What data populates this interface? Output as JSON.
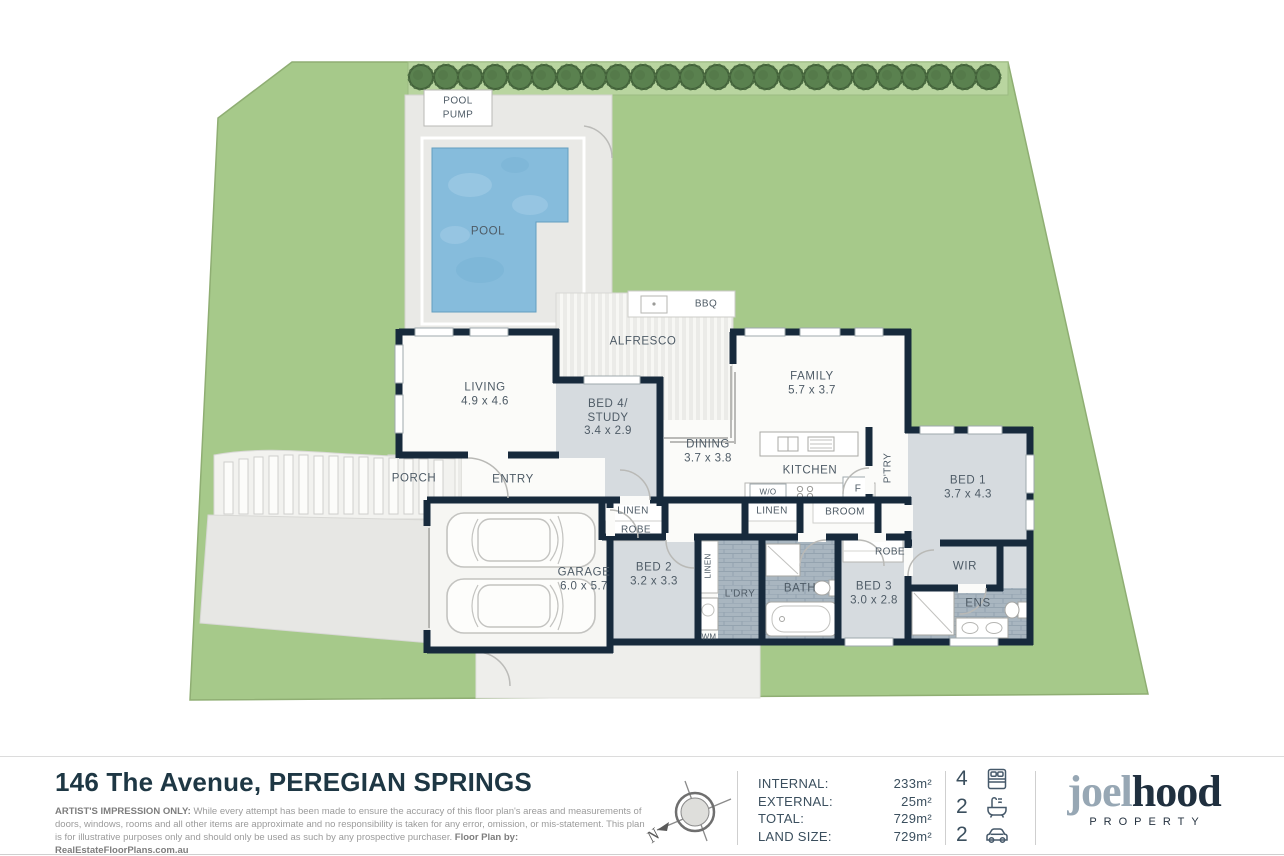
{
  "plan": {
    "pool_pump": {
      "line1": "POOL",
      "line2": "PUMP"
    },
    "pool": "POOL",
    "bbq": "BBQ",
    "alfresco": "ALFRESCO",
    "living": {
      "name": "LIVING",
      "dims": "4.9 x 4.6"
    },
    "bed4": {
      "line1": "BED 4/",
      "line2": "STUDY",
      "dims": "3.4 x 2.9"
    },
    "family": {
      "name": "FAMILY",
      "dims": "5.7 x 3.7"
    },
    "dining": {
      "name": "DINING",
      "dims": "3.7 x 3.8"
    },
    "kitchen": "KITCHEN",
    "wall_oven": "W/O",
    "fridge": "F",
    "pantry": "P'TRY",
    "bed1": {
      "name": "BED 1",
      "dims": "3.7 x 4.3"
    },
    "porch": "PORCH",
    "entry": "ENTRY",
    "linen_entry": "LINEN",
    "robe_entry": "ROBE",
    "linen_hall": "LINEN",
    "broom": "BROOM",
    "garage": {
      "name": "GARAGE",
      "dims": "6.0 x 5.7"
    },
    "bed2": {
      "name": "BED 2",
      "dims": "3.2 x 3.3"
    },
    "linen_ldry": "LINEN",
    "laundry": "L'DRY",
    "wm": "WM",
    "bath": "BATH",
    "bed3": {
      "name": "BED 3",
      "dims": "3.0 x 2.8"
    },
    "robe_bed3": "ROBE",
    "wir": "WIR",
    "ens": "ENS"
  },
  "footer": {
    "address": "146 The Avenue, PEREGIAN SPRINGS",
    "disclaimer_bold": "ARTIST'S IMPRESSION ONLY:",
    "disclaimer_text": " While every attempt has been made to ensure the accuracy of this floor plan's areas and measurements of doors, windows, rooms and all other items are approximate and no responsibility is taken for any error, omission, or mis-statement. This plan is for illustrative purposes only and should only be used as such by any prospective purchaser. ",
    "disclaimer_credit": "Floor Plan by: RealEstateFloorPlans.com.au",
    "compass_letter": "N",
    "stats": [
      {
        "label": "INTERNAL:",
        "value": "233m²"
      },
      {
        "label": "EXTERNAL:",
        "value": "25m²"
      },
      {
        "label": "TOTAL:",
        "value": "729m²"
      },
      {
        "label": "LAND SIZE:",
        "value": "729m²"
      }
    ],
    "counts": {
      "beds": "4",
      "baths": "2",
      "cars": "2"
    },
    "logo": {
      "part1": "joel",
      "part2": "hood",
      "tagline": "PROPERTY"
    }
  },
  "colors": {
    "wall_navy": "#172a3c",
    "land_green": "#a6c98a",
    "tree_green": "#5a814f",
    "pool_blue": "#86bcdc",
    "room_grey": "#d6dbdf",
    "tile_grey": "#a9b6c0",
    "brand_navy": "#20303f",
    "brand_slate": "#97a7b4"
  }
}
